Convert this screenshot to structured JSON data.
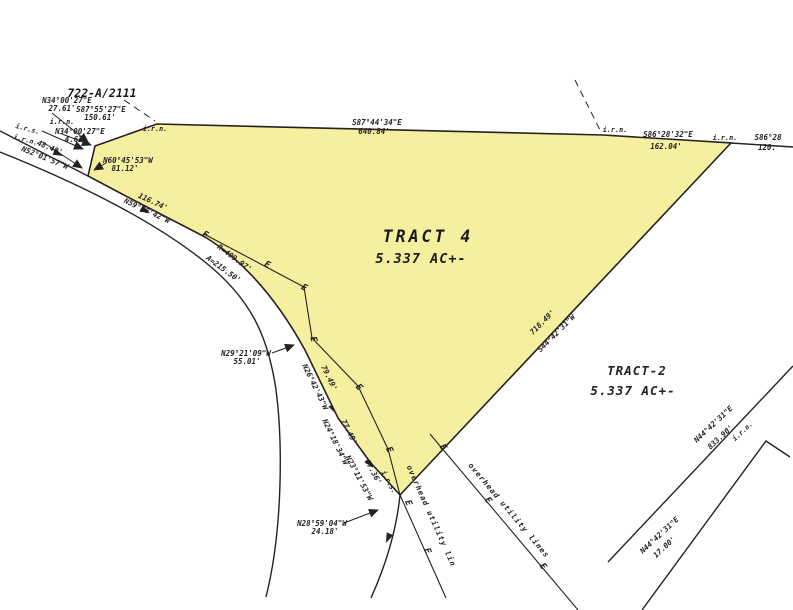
{
  "deed": "722-A/2111",
  "markers": {
    "iron_rod_set": "i.r.s.",
    "iron_rod_new": "i.r.n.",
    "pole": "E"
  },
  "tract4": {
    "name": "TRACT 4",
    "area": "5.337 AC+-"
  },
  "tract2": {
    "name": "TRACT-2",
    "area": "5.337 AC+-",
    "east_bearing": "N44°42'31\"E",
    "east_dist": "833.90'",
    "south_bearing": "N44°42'31\"E",
    "south_dist": "17.00'"
  },
  "calls": {
    "c1b": "N34°00'27\"E",
    "c1d": "27.61'",
    "c2b": "S87°55'27\"E",
    "c2d": "150.61'",
    "c3b": "N34°00'27\"E",
    "c3d": "4.63'",
    "top_b": "S87°44'34\"E",
    "top_d": "640.84'",
    "tr_b": "S86°28'32\"E",
    "tr_d": "162.04'",
    "edge_b": "S86°28",
    "edge_d": "120.",
    "se_d": "718.49'",
    "se_b": "S44°42'31\"W"
  },
  "road": {
    "r1d": "48.48'",
    "r1b": "N52°01'57\"W",
    "r2b": "N60°45'53\"W",
    "r2d": "81.12'",
    "r3d": "116.74'",
    "r3b": "N59°28'42\"W",
    "curve_r": "R=409.97'",
    "curve_a": "A=215.50'",
    "r4b": "N29°21'09\"W",
    "r4d": "55.01'",
    "r5d": "79.49'",
    "r5b": "N26°42'43\"W",
    "r6d": "77.49'",
    "r6b": "N24°18'34\"W",
    "r7d": "67.36'",
    "r7b": "N23°11'53\"W",
    "r8b": "N28°59'04\"W",
    "r8d": "24.18'"
  },
  "utility": {
    "short": "overhead utility lin",
    "long": "overhead utility lines"
  },
  "colors": {
    "tract_fill": "#f5efa0",
    "ink": "#242220"
  }
}
